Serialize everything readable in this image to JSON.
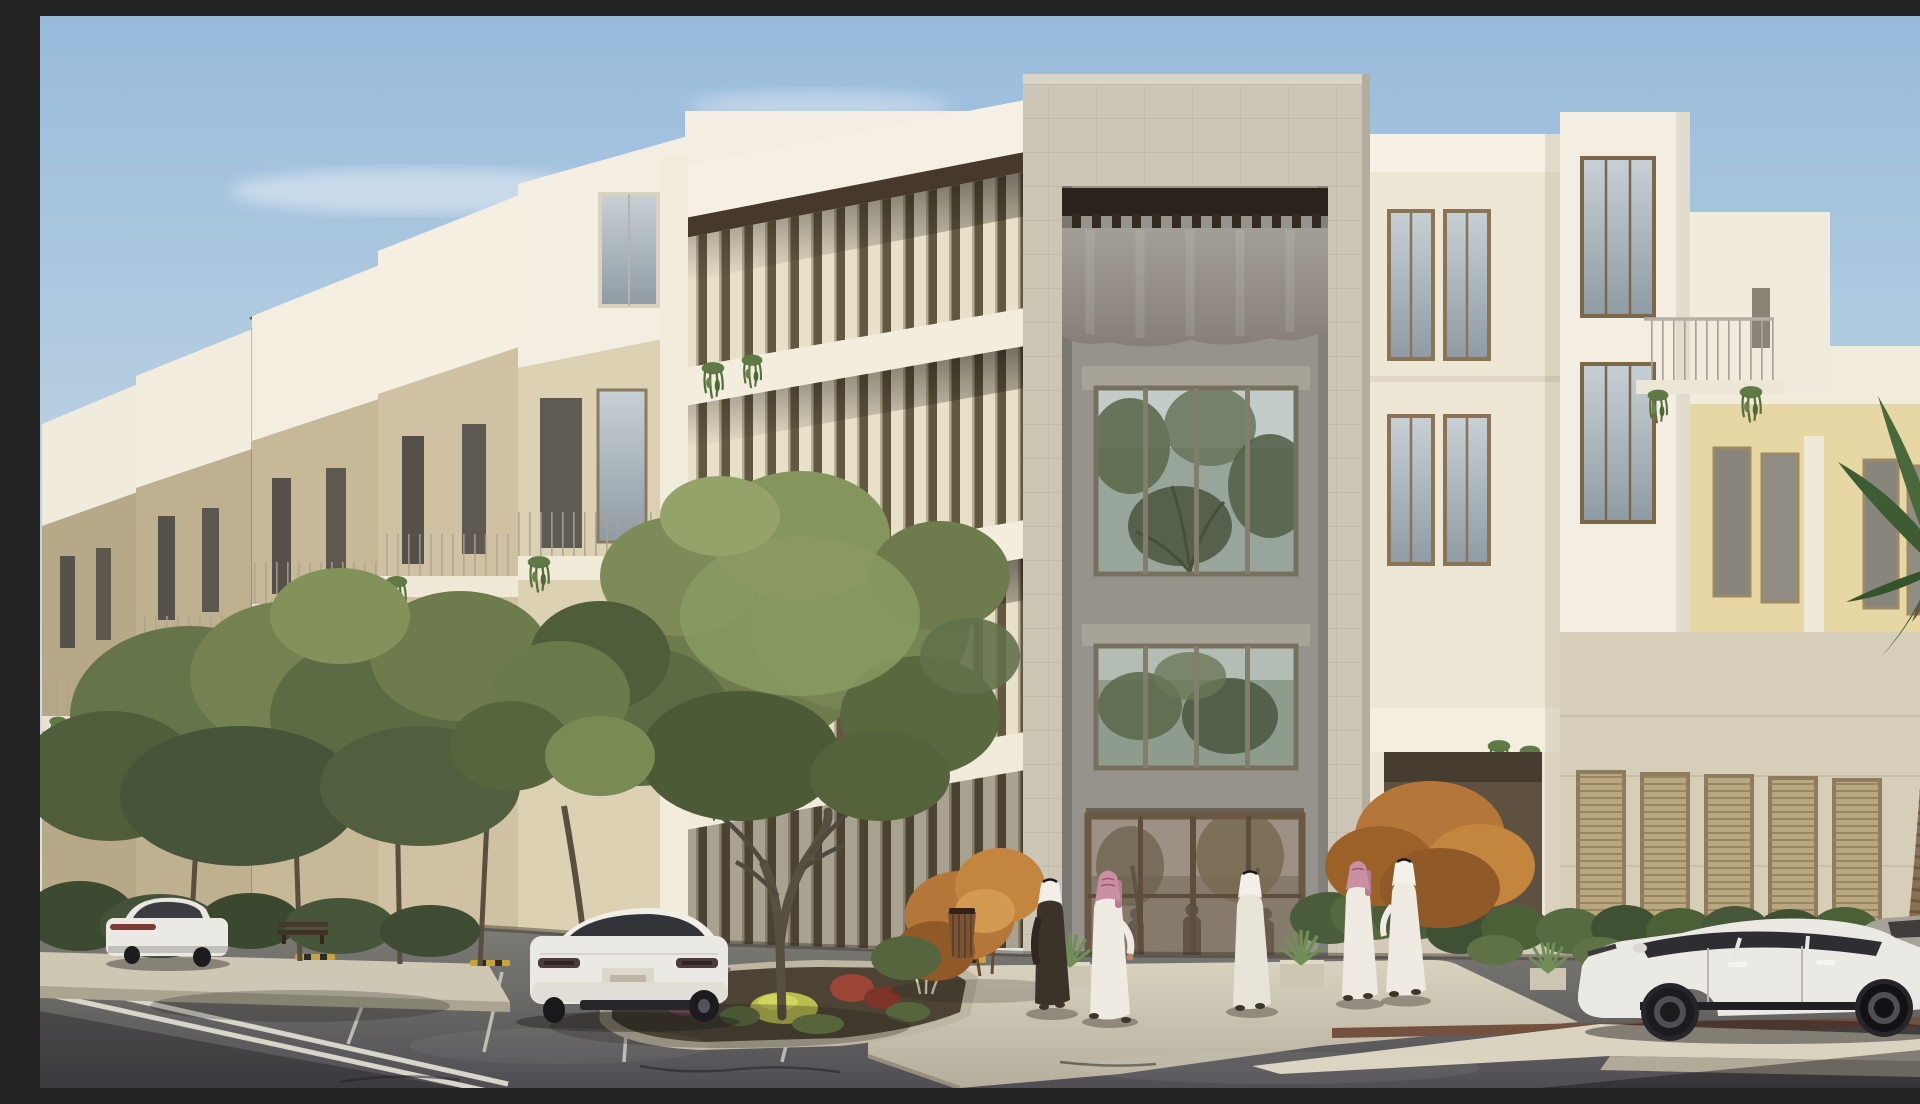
{
  "meta": {
    "title": "Architectural rendering of a modern residential complex",
    "canvas": {
      "width": 1920,
      "height": 1072
    }
  },
  "scene": {
    "description": "Daytime architectural rendering of a modern beige-and-white apartment complex with a tall stone entrance portal, louvered balconies with hanging plants, landscaped parking court with olive trees and colorful planting, five men in traditional white and dark thobes with ghutras walking by the lobby, three white sedans and one gray car, a date palm at the right, under a soft blue sky with wispy clouds and two distant birds.",
    "time_of_day": "morning with low warm sun from the left",
    "sky": {
      "clouds": "thin wispy white",
      "birds": 2
    },
    "buildings": {
      "style": "modern Najdi-inspired apartment blocks",
      "left_row_modules": 5,
      "features": [
        "stepped white roof volumes",
        "beige stucco facades",
        "vertical louver fins",
        "balconies with thin metal railings",
        "hanging planters",
        "stone-clad entrance portal",
        "dark wood pergola slats",
        "gray canopy drape",
        "glass lobby reflecting trees"
      ],
      "entrance": {
        "frame_material": "travertine stone tiles",
        "interior_wall": "warm gray",
        "glazing": "bronze-framed windows reflecting trees and sky"
      },
      "right_wing": {
        "accent_wall": "pale yellow",
        "ground_floor": "light stone base with louvered shutters",
        "roof_terrace": "railing with trailing plants"
      }
    },
    "people": [
      {
        "id": 1,
        "garment": "dark brown thobe",
        "headdress": "white ghutra with black agal",
        "location": "left of entrance walkway"
      },
      {
        "id": 2,
        "garment": "white thobe",
        "headdress": "pink patterned shemagh",
        "location": "walking past the entrance"
      },
      {
        "id": 3,
        "garment": "off-white thobe",
        "headdress": "white ghutra",
        "location": "right of entrance, facing left"
      },
      {
        "id": 4,
        "garment": "white thobe",
        "headdress": "pink patterned shemagh",
        "location": "sidewalk near the corner"
      },
      {
        "id": 5,
        "garment": "white thobe",
        "headdress": "white ghutra",
        "location": "sidewalk near the corner"
      }
    ],
    "vehicles": [
      {
        "type": "sedan",
        "color": "white",
        "view": "rear three-quarter",
        "location": "left parking bay"
      },
      {
        "type": "sedan",
        "color": "white",
        "view": "rear three-quarter",
        "location": "center parking bay"
      },
      {
        "type": "sedan",
        "color": "white",
        "view": "side profile",
        "location": "right curb"
      },
      {
        "type": "car",
        "color": "gray",
        "view": "partial front",
        "location": "far right edge"
      }
    ],
    "vegetation": [
      "olive trees",
      "colorful planting bed with purple, red and chartreuse plants",
      "rust-orange autumn shrubs",
      "green hedges",
      "agave planters",
      "date palm",
      "hanging balcony plants"
    ],
    "street": {
      "surface": "asphalt",
      "markings": [
        "double white center line",
        "white parking bay lines"
      ],
      "furniture": [
        "wooden litter bin",
        "wooden bench",
        "yellow-black wheel stops"
      ],
      "sidewalk": "light granite entrance plaza with shallow steps"
    }
  },
  "palette": {
    "sky_top": "#98bbdc",
    "sky_horizon": "#e9e7da",
    "building_white": "#f3eee1",
    "building_beige": "#cfc1a1",
    "building_beige_dark": "#b7a987",
    "building_yellow": "#e7d7a4",
    "stone_portal": "#cdc6b7",
    "recess_gray": "#96938c",
    "curtain_gray": "#8f8b84",
    "wood_dark": "#3c3022",
    "louver_cream": "#e9e0ca",
    "glass_sky": "#b7c3c8",
    "glass_tree": "#5f6b4c",
    "ground_floor_stone": "#d7ceba",
    "asphalt": "#77766f",
    "curb_light": "#d9d3c0",
    "plaza": "#cdc7b4",
    "line_white": "#d8d5ca",
    "tree_green": "#6d7b4d",
    "hedge_green": "#46573a",
    "orange_foliage": "#b5763a",
    "plant_purple": "#95566f",
    "plant_red": "#9c4435",
    "plant_yellow": "#b9bd4e",
    "palm_green": "#3e5c34",
    "palm_trunk": "#8a7052",
    "car_white": "#ebe9e3",
    "car_glass": "#2e2d31",
    "wheel_black": "#1c1b1e",
    "skin": "#b98a63",
    "thobe_white": "#efebe3",
    "thobe_offwhite": "#e9e4d9",
    "robe_dark": "#3b332a",
    "shemagh_pink": "#c98fa2"
  }
}
